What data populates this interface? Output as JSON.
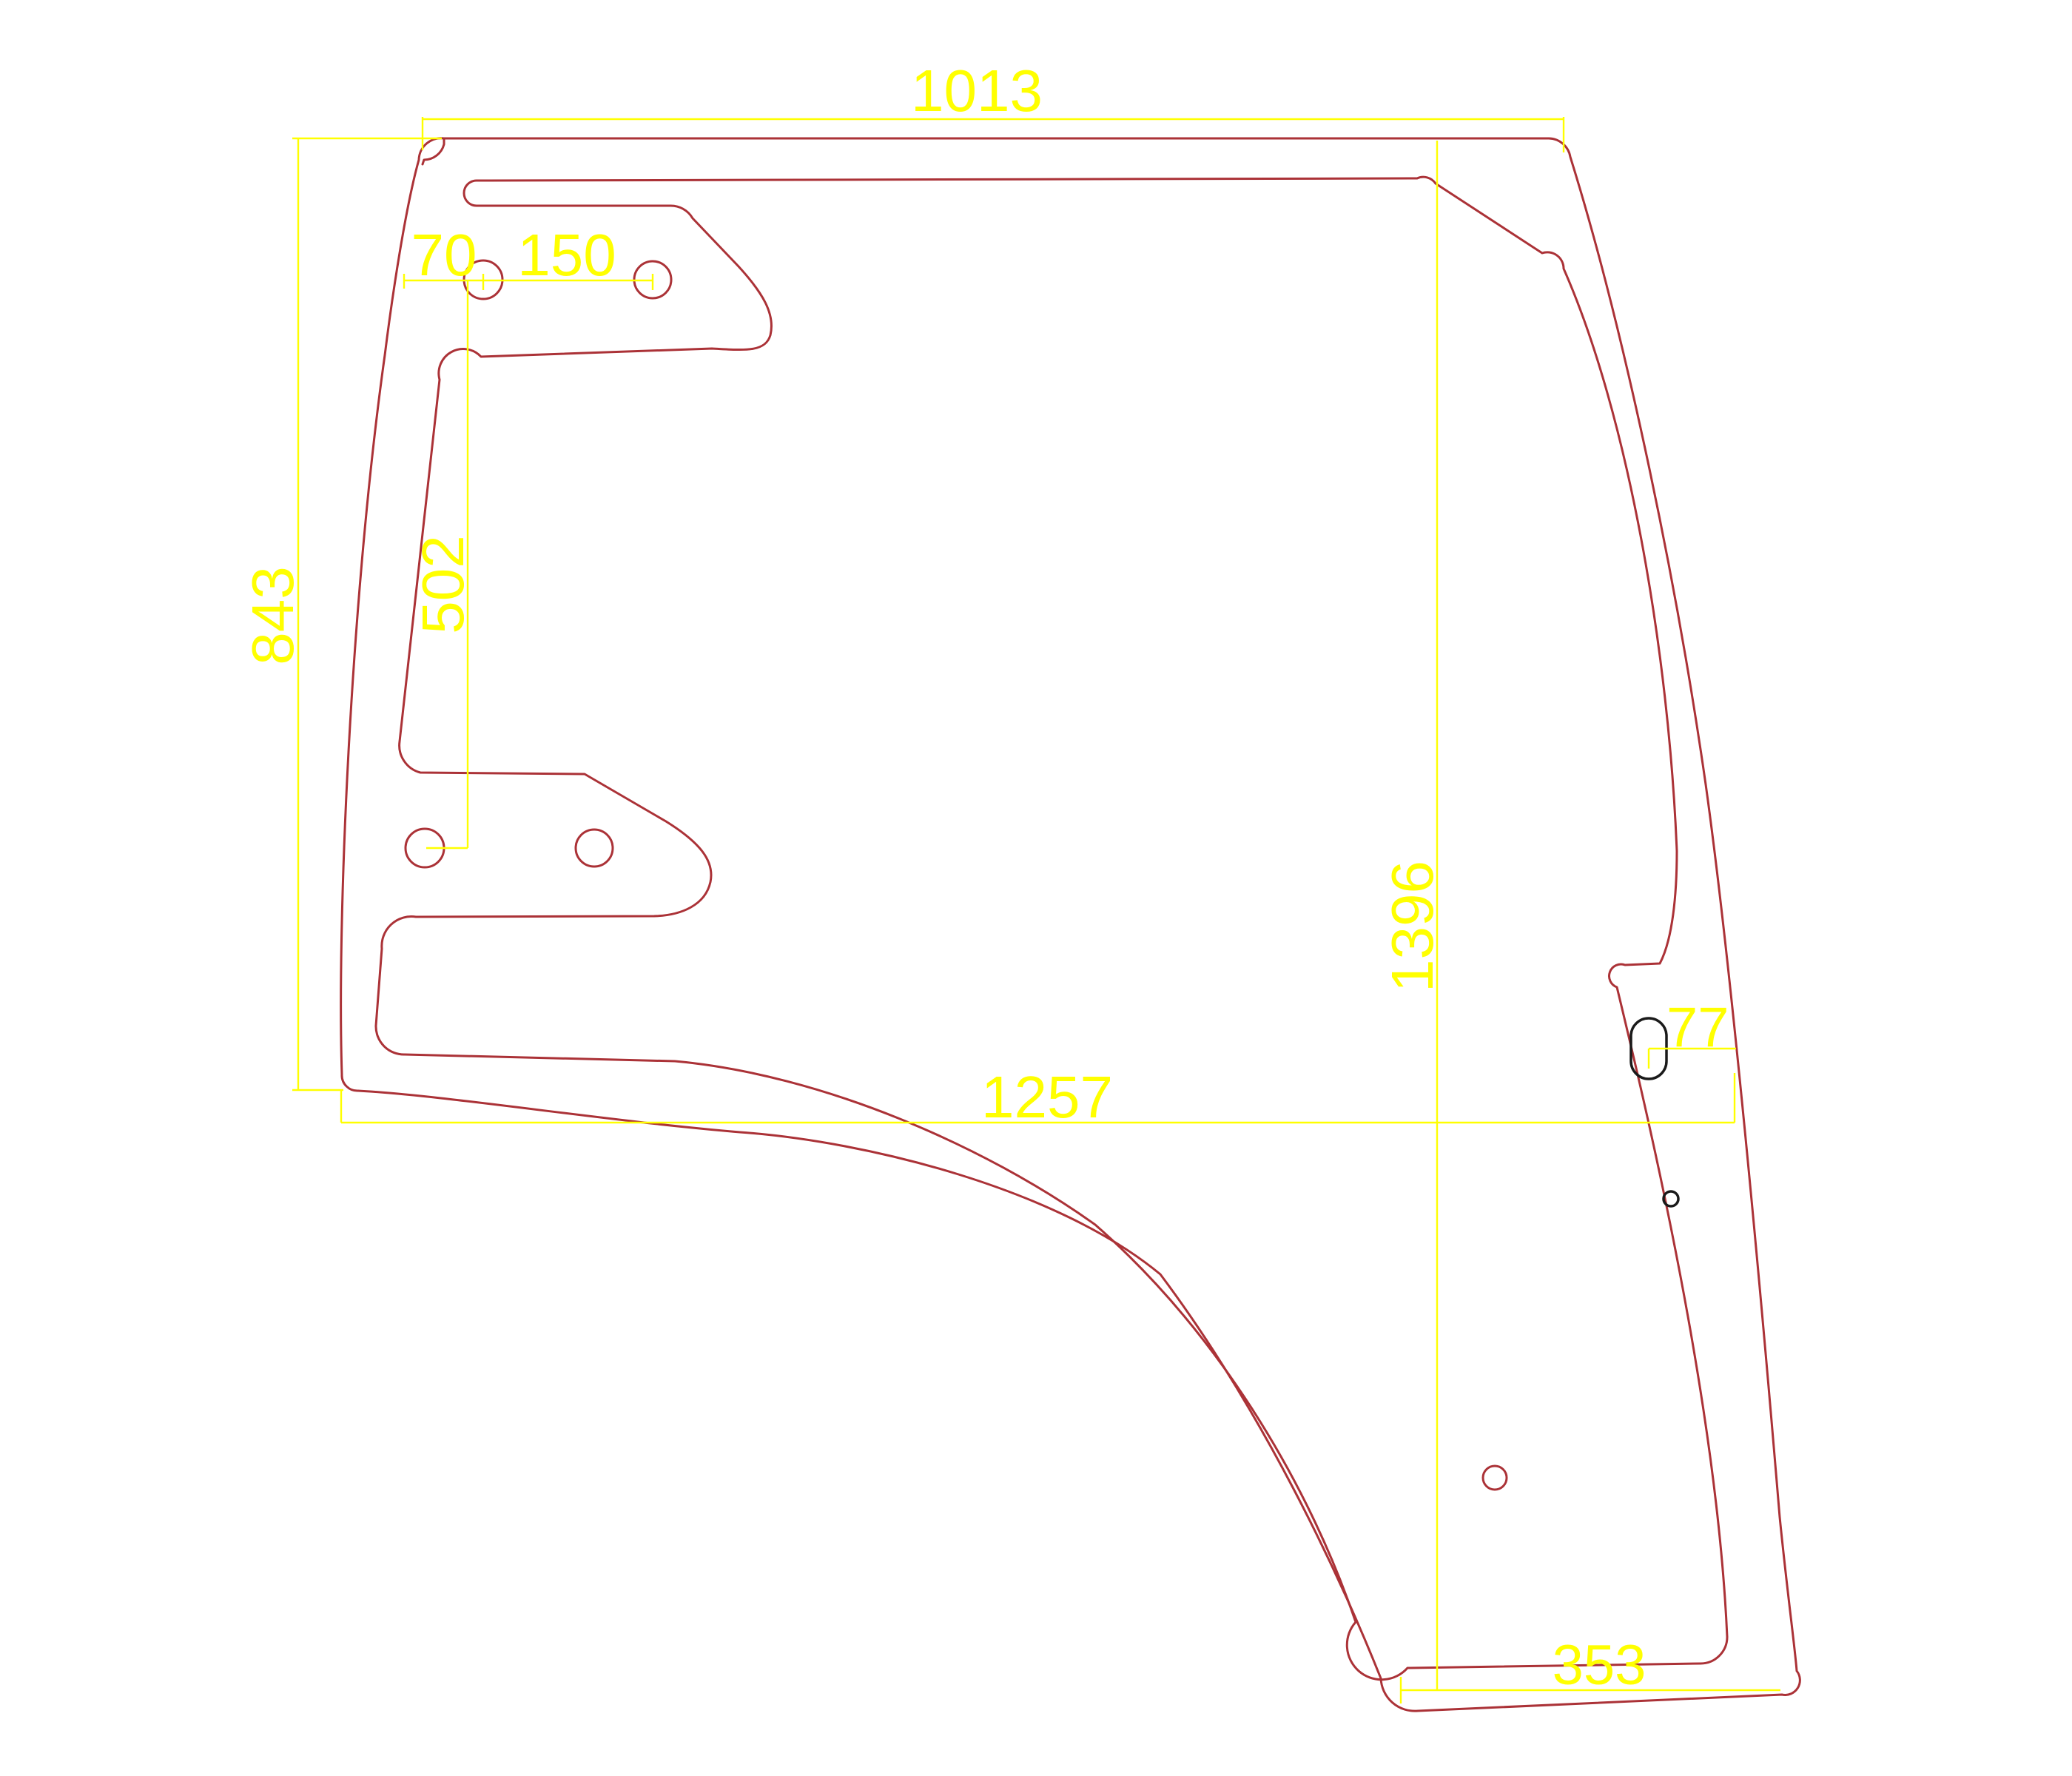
{
  "drawing": {
    "type": "cad-glass-panel-drawing",
    "background_color": "#ffffff",
    "outline_color": "#ab3237",
    "dimension_color": "#ffff00",
    "dark_hole_color": "#1a1a1a",
    "dimensions": {
      "top_width": {
        "label": "1013"
      },
      "upper_hole_edge_offset": {
        "label": "70"
      },
      "upper_hole_spacing": {
        "label": "150"
      },
      "left_height": {
        "label": "843"
      },
      "bracket_hole_vertical_spacing": {
        "label": "502"
      },
      "right_height": {
        "label": "1396"
      },
      "middle_width": {
        "label": "1257"
      },
      "oval_to_edge_offset": {
        "label": "77"
      },
      "bottom_width": {
        "label": "353"
      }
    }
  }
}
